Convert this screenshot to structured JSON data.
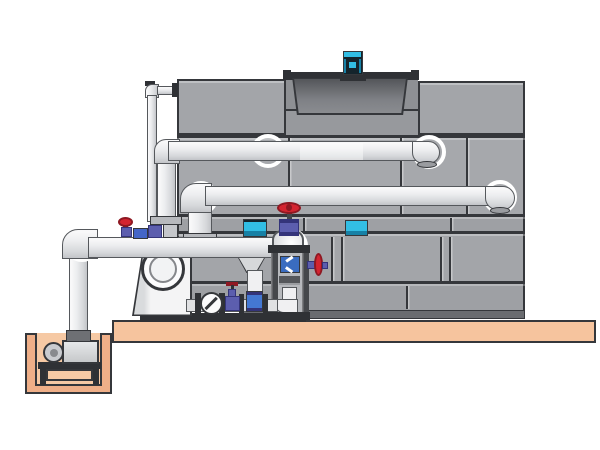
{
  "diagram": {
    "type": "technical-illustration",
    "subject": "Closed-circuit cooling tower installation with fan motor, pump skid, valves, sump pit pump and interconnecting piping on a concrete slab",
    "visible_text": []
  },
  "palette": {
    "background": "#FFFFFF",
    "outline": "#35373B",
    "panel": "#A6A8AC",
    "panel_alt": "#9EA0A4",
    "panel_top": "#A3A5A9",
    "panel_recess": "#8E9094",
    "panel_floor": "#97999D",
    "tower_base_strip": "#6A6C70",
    "pipe_edge": "#55585C",
    "highlight_ring": "#FFFFFF",
    "slab": "#F6C49E",
    "pit_wall": "#EFAF88",
    "pit_inner": "#F6C9A4",
    "steel_dark": "#2F3135",
    "steel": "#45474B",
    "steel_light": "#B7B9BD",
    "red": "#D42430",
    "red_dark": "#8E1822",
    "valve_purple": "#5C5EAE",
    "valve_purple_dark": "#34347A",
    "blue": "#4478D2",
    "flow_blue": "#3A6CC0",
    "cyan": "#32BEE4",
    "cyan_dark": "#1781A6",
    "motor_navy": "#14242C",
    "pump_gray": "#D6D8DA",
    "white_pipe": "#F0F0F2"
  },
  "components": [
    {
      "name": "cooling-tower-cabinet",
      "color": "#A3A5A9"
    },
    {
      "name": "fan-motor",
      "color": "#32BEE4"
    },
    {
      "name": "fan-shroud",
      "color": "#5A5C60"
    },
    {
      "name": "upper-inlet-pipe",
      "color": "#ECEDEF"
    },
    {
      "name": "lower-inlet-pipe",
      "color": "#ECEDEF"
    },
    {
      "name": "main-suction-pipe",
      "color": "#ECEDEF"
    },
    {
      "name": "equalizer-standpipe",
      "color": "#E6E7E9"
    },
    {
      "name": "vertical-inline-pump",
      "color": "#32BEE4"
    },
    {
      "name": "end-suction-pump-inlet",
      "color": "#FCFCFD"
    },
    {
      "name": "gate-valve",
      "color": "#D42430"
    },
    {
      "name": "check-valve",
      "color": "#FBFBFC"
    },
    {
      "name": "globe-valve",
      "color": "#5C5EAE"
    },
    {
      "name": "makeup-valve-cluster",
      "color": "#4466C8"
    },
    {
      "name": "equipment-stand",
      "color": "#45474B"
    },
    {
      "name": "basin-control-box",
      "color": "#32BEE4"
    },
    {
      "name": "sump-pit",
      "color": "#EFAF88"
    },
    {
      "name": "sump-pump",
      "color": "#D7D9DD"
    },
    {
      "name": "concrete-slab",
      "color": "#F6C49E"
    }
  ]
}
